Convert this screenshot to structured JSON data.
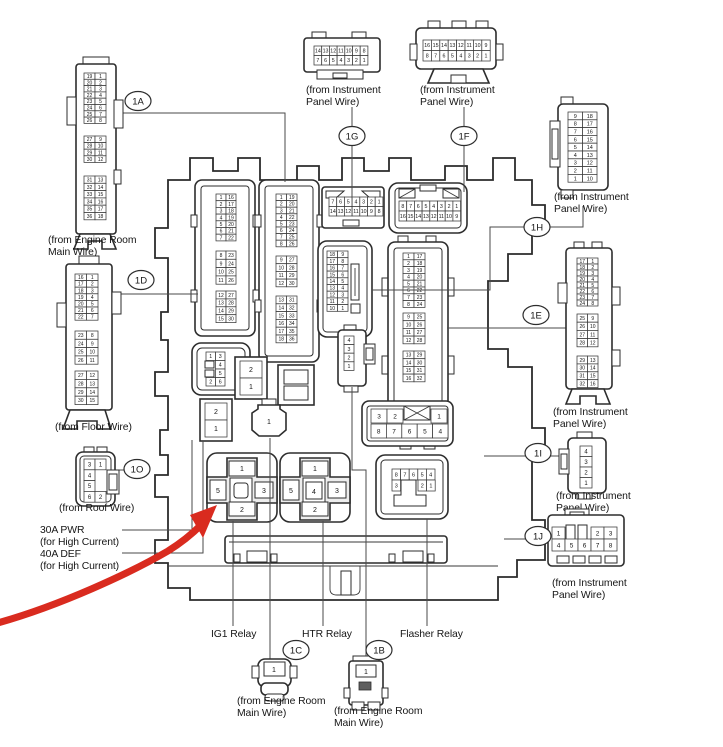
{
  "colors": {
    "line": "#2d2d2d",
    "red": "#d92b1f",
    "background": "#ffffff"
  },
  "callouts": {
    "1A": "1A",
    "1B": "1B",
    "1C": "1C",
    "1D": "1D",
    "1E": "1E",
    "1F": "1F",
    "1G": "1G",
    "1H": "1H",
    "1I": "1I",
    "1J": "1J",
    "1O": "1O"
  },
  "labels": {
    "engine_room": [
      "(from Engine Room",
      "Main Wire)"
    ],
    "instrument": [
      "(from Instrument",
      "Panel Wire)"
    ],
    "floor": "(from Floor Wire)",
    "roof": "(from Roof Wire)",
    "pwr": [
      "30A PWR",
      "(for High Current)"
    ],
    "def": [
      "40A DEF",
      "(for High Current)"
    ],
    "ig1": "IG1 Relay",
    "htr": "HTR Relay",
    "flasher": "Flasher Relay"
  },
  "connectors": {
    "ext1A": {
      "g1": [
        [
          "19",
          "1"
        ],
        [
          "20",
          "2"
        ],
        [
          "21",
          "3"
        ],
        [
          "22",
          "4"
        ],
        [
          "23",
          "5"
        ],
        [
          "24",
          "6"
        ],
        [
          "25",
          "7"
        ],
        [
          "26",
          "8"
        ]
      ],
      "g2": [
        [
          "27",
          "9"
        ],
        [
          "28",
          "10"
        ],
        [
          "29",
          "11"
        ],
        [
          "30",
          "12"
        ]
      ],
      "g3": [
        [
          "31",
          "13"
        ],
        [
          "32",
          "14"
        ],
        [
          "33",
          "15"
        ],
        [
          "34",
          "16"
        ],
        [
          "35",
          "17"
        ],
        [
          "36",
          "18"
        ]
      ]
    },
    "ext1D": {
      "g1": [
        [
          "16",
          "1"
        ],
        [
          "17",
          "2"
        ],
        [
          "18",
          "3"
        ],
        [
          "19",
          "4"
        ],
        [
          "20",
          "5"
        ],
        [
          "21",
          "6"
        ],
        [
          "22",
          "7"
        ]
      ],
      "g2": [
        [
          "23",
          "8"
        ],
        [
          "24",
          "9"
        ],
        [
          "25",
          "10"
        ],
        [
          "26",
          "11"
        ]
      ],
      "g3": [
        [
          "27",
          "12"
        ],
        [
          "28",
          "13"
        ],
        [
          "29",
          "14"
        ],
        [
          "30",
          "15"
        ]
      ]
    },
    "ext1G": {
      "rows": [
        [
          "14",
          "13",
          "12",
          "11",
          "10",
          "9",
          "8"
        ],
        [
          "7",
          "6",
          "5",
          "4",
          "3",
          "2",
          "1"
        ]
      ]
    },
    "ext1F": {
      "rows": [
        [
          "16",
          "15",
          "14",
          "13",
          "12",
          "11",
          "10",
          "9"
        ],
        [
          "8",
          "7",
          "6",
          "5",
          "4",
          "3",
          "2",
          "1"
        ]
      ]
    },
    "ext1H": {
      "rows": [
        [
          "9",
          "18"
        ],
        [
          "8",
          "17"
        ],
        [
          "7",
          "16"
        ],
        [
          "6",
          "15"
        ],
        [
          "5",
          "14"
        ],
        [
          "4",
          "13"
        ],
        [
          "3",
          "12"
        ],
        [
          "2",
          "11"
        ],
        [
          "1",
          "10"
        ]
      ]
    },
    "ext1E": {
      "g1": [
        [
          "17",
          "1"
        ],
        [
          "18",
          "2"
        ],
        [
          "19",
          "3"
        ],
        [
          "20",
          "4"
        ],
        [
          "21",
          "5"
        ],
        [
          "22",
          "6"
        ],
        [
          "23",
          "7"
        ],
        [
          "24",
          "8"
        ]
      ],
      "g2": [
        [
          "25",
          "9"
        ],
        [
          "26",
          "10"
        ],
        [
          "27",
          "11"
        ],
        [
          "28",
          "12"
        ]
      ],
      "g3": [
        [
          "29",
          "13"
        ],
        [
          "30",
          "14"
        ],
        [
          "31",
          "15"
        ],
        [
          "32",
          "16"
        ]
      ]
    },
    "ext1O": {
      "rows": [
        [
          "3",
          "1"
        ],
        [
          "4",
          ""
        ],
        [
          "5",
          ""
        ],
        [
          "6",
          "2"
        ]
      ]
    },
    "ext1I": {
      "rows": [
        [
          "4"
        ],
        [
          "3"
        ],
        [
          "2"
        ],
        [
          "1"
        ]
      ]
    },
    "ext1J": {
      "top_left": [
        [
          "1"
        ]
      ],
      "top_right": [
        [
          "2",
          "3"
        ]
      ],
      "bottom": [
        [
          "4",
          "5",
          "6",
          "7",
          "8"
        ]
      ]
    },
    "ext1C": {
      "pin": "1"
    },
    "ext1B": {
      "pin": "1"
    },
    "int_left": {
      "g1": [
        [
          "1",
          "16"
        ],
        [
          "2",
          "17"
        ],
        [
          "3",
          "18"
        ],
        [
          "4",
          "19"
        ],
        [
          "5",
          "20"
        ],
        [
          "6",
          "21"
        ],
        [
          "7",
          "22"
        ]
      ],
      "g2": [
        [
          "8",
          "23"
        ],
        [
          "9",
          "24"
        ],
        [
          "10",
          "25"
        ],
        [
          "11",
          "26"
        ]
      ],
      "g3": [
        [
          "12",
          "27"
        ],
        [
          "13",
          "28"
        ],
        [
          "14",
          "29"
        ],
        [
          "15",
          "30"
        ]
      ]
    },
    "int_mid": {
      "g1": [
        [
          "1",
          "19"
        ],
        [
          "2",
          "20"
        ],
        [
          "3",
          "21"
        ],
        [
          "4",
          "22"
        ],
        [
          "5",
          "23"
        ],
        [
          "6",
          "24"
        ],
        [
          "7",
          "25"
        ],
        [
          "8",
          "26"
        ]
      ],
      "g2": [
        [
          "9",
          "27"
        ],
        [
          "10",
          "28"
        ],
        [
          "11",
          "29"
        ],
        [
          "12",
          "30"
        ]
      ],
      "g3": [
        [
          "13",
          "31"
        ],
        [
          "14",
          "32"
        ],
        [
          "15",
          "33"
        ],
        [
          "16",
          "34"
        ],
        [
          "17",
          "35"
        ],
        [
          "18",
          "36"
        ]
      ]
    },
    "int1G": {
      "rows": [
        [
          "7",
          "6",
          "5",
          "4",
          "3",
          "2",
          "1"
        ],
        [
          "14",
          "13",
          "12",
          "11",
          "10",
          "9",
          "8"
        ]
      ]
    },
    "int1F": {
      "rows": [
        [
          "8",
          "7",
          "6",
          "5",
          "4",
          "3",
          "2",
          "1"
        ],
        [
          "16",
          "15",
          "14",
          "13",
          "12",
          "11",
          "10",
          "9"
        ]
      ]
    },
    "int1H": {
      "rows": [
        [
          "18",
          "9"
        ],
        [
          "17",
          "8"
        ],
        [
          "16",
          "7"
        ],
        [
          "15",
          "6"
        ],
        [
          "14",
          "5"
        ],
        [
          "13",
          "4"
        ],
        [
          "12",
          "3"
        ],
        [
          "11",
          "2"
        ],
        [
          "10",
          "1"
        ]
      ]
    },
    "int1E": {
      "g1": [
        [
          "1",
          "17"
        ],
        [
          "2",
          "18"
        ],
        [
          "3",
          "19"
        ],
        [
          "4",
          "20"
        ],
        [
          "5",
          "21"
        ],
        [
          "6",
          "22"
        ],
        [
          "7",
          "23"
        ],
        [
          "8",
          "24"
        ]
      ],
      "g2": [
        [
          "9",
          "25"
        ],
        [
          "10",
          "26"
        ],
        [
          "11",
          "27"
        ],
        [
          "12",
          "28"
        ]
      ],
      "g3": [
        [
          "13",
          "29"
        ],
        [
          "14",
          "30"
        ],
        [
          "15",
          "31"
        ],
        [
          "16",
          "32"
        ]
      ]
    },
    "int1O": {
      "rows": [
        [
          "1",
          "3"
        ],
        [
          "",
          "4"
        ],
        [
          "",
          "5"
        ],
        [
          "2",
          "6"
        ]
      ]
    },
    "int1B": {
      "rows": [
        [
          "4"
        ],
        [
          "3"
        ],
        [
          "2"
        ],
        [
          "1"
        ]
      ]
    },
    "fuse_a": {
      "rows": [
        [
          "2"
        ],
        [
          "1"
        ]
      ]
    },
    "fuse_b": {
      "rows": [
        [
          "2"
        ],
        [
          "1"
        ]
      ]
    },
    "fuse_c": {
      "pin": "1"
    },
    "socket8": {
      "top_left": [
        [
          "3",
          "2"
        ]
      ],
      "top_right": [
        [
          "1"
        ]
      ],
      "bottom": [
        [
          "8",
          "7",
          "6",
          "5",
          "4"
        ]
      ]
    },
    "ig1": {
      "top": "1",
      "left": "5",
      "right": "3",
      "bottom": "2"
    },
    "htr": {
      "top": "1",
      "left": "5",
      "center": "4",
      "right": "3",
      "bottom": "2"
    },
    "flasher": {
      "top": [
        [
          "8",
          "7",
          "6",
          "5",
          "4"
        ]
      ],
      "b1": [
        [
          "3"
        ]
      ],
      "b2": [
        [
          "2",
          "1"
        ]
      ]
    }
  }
}
